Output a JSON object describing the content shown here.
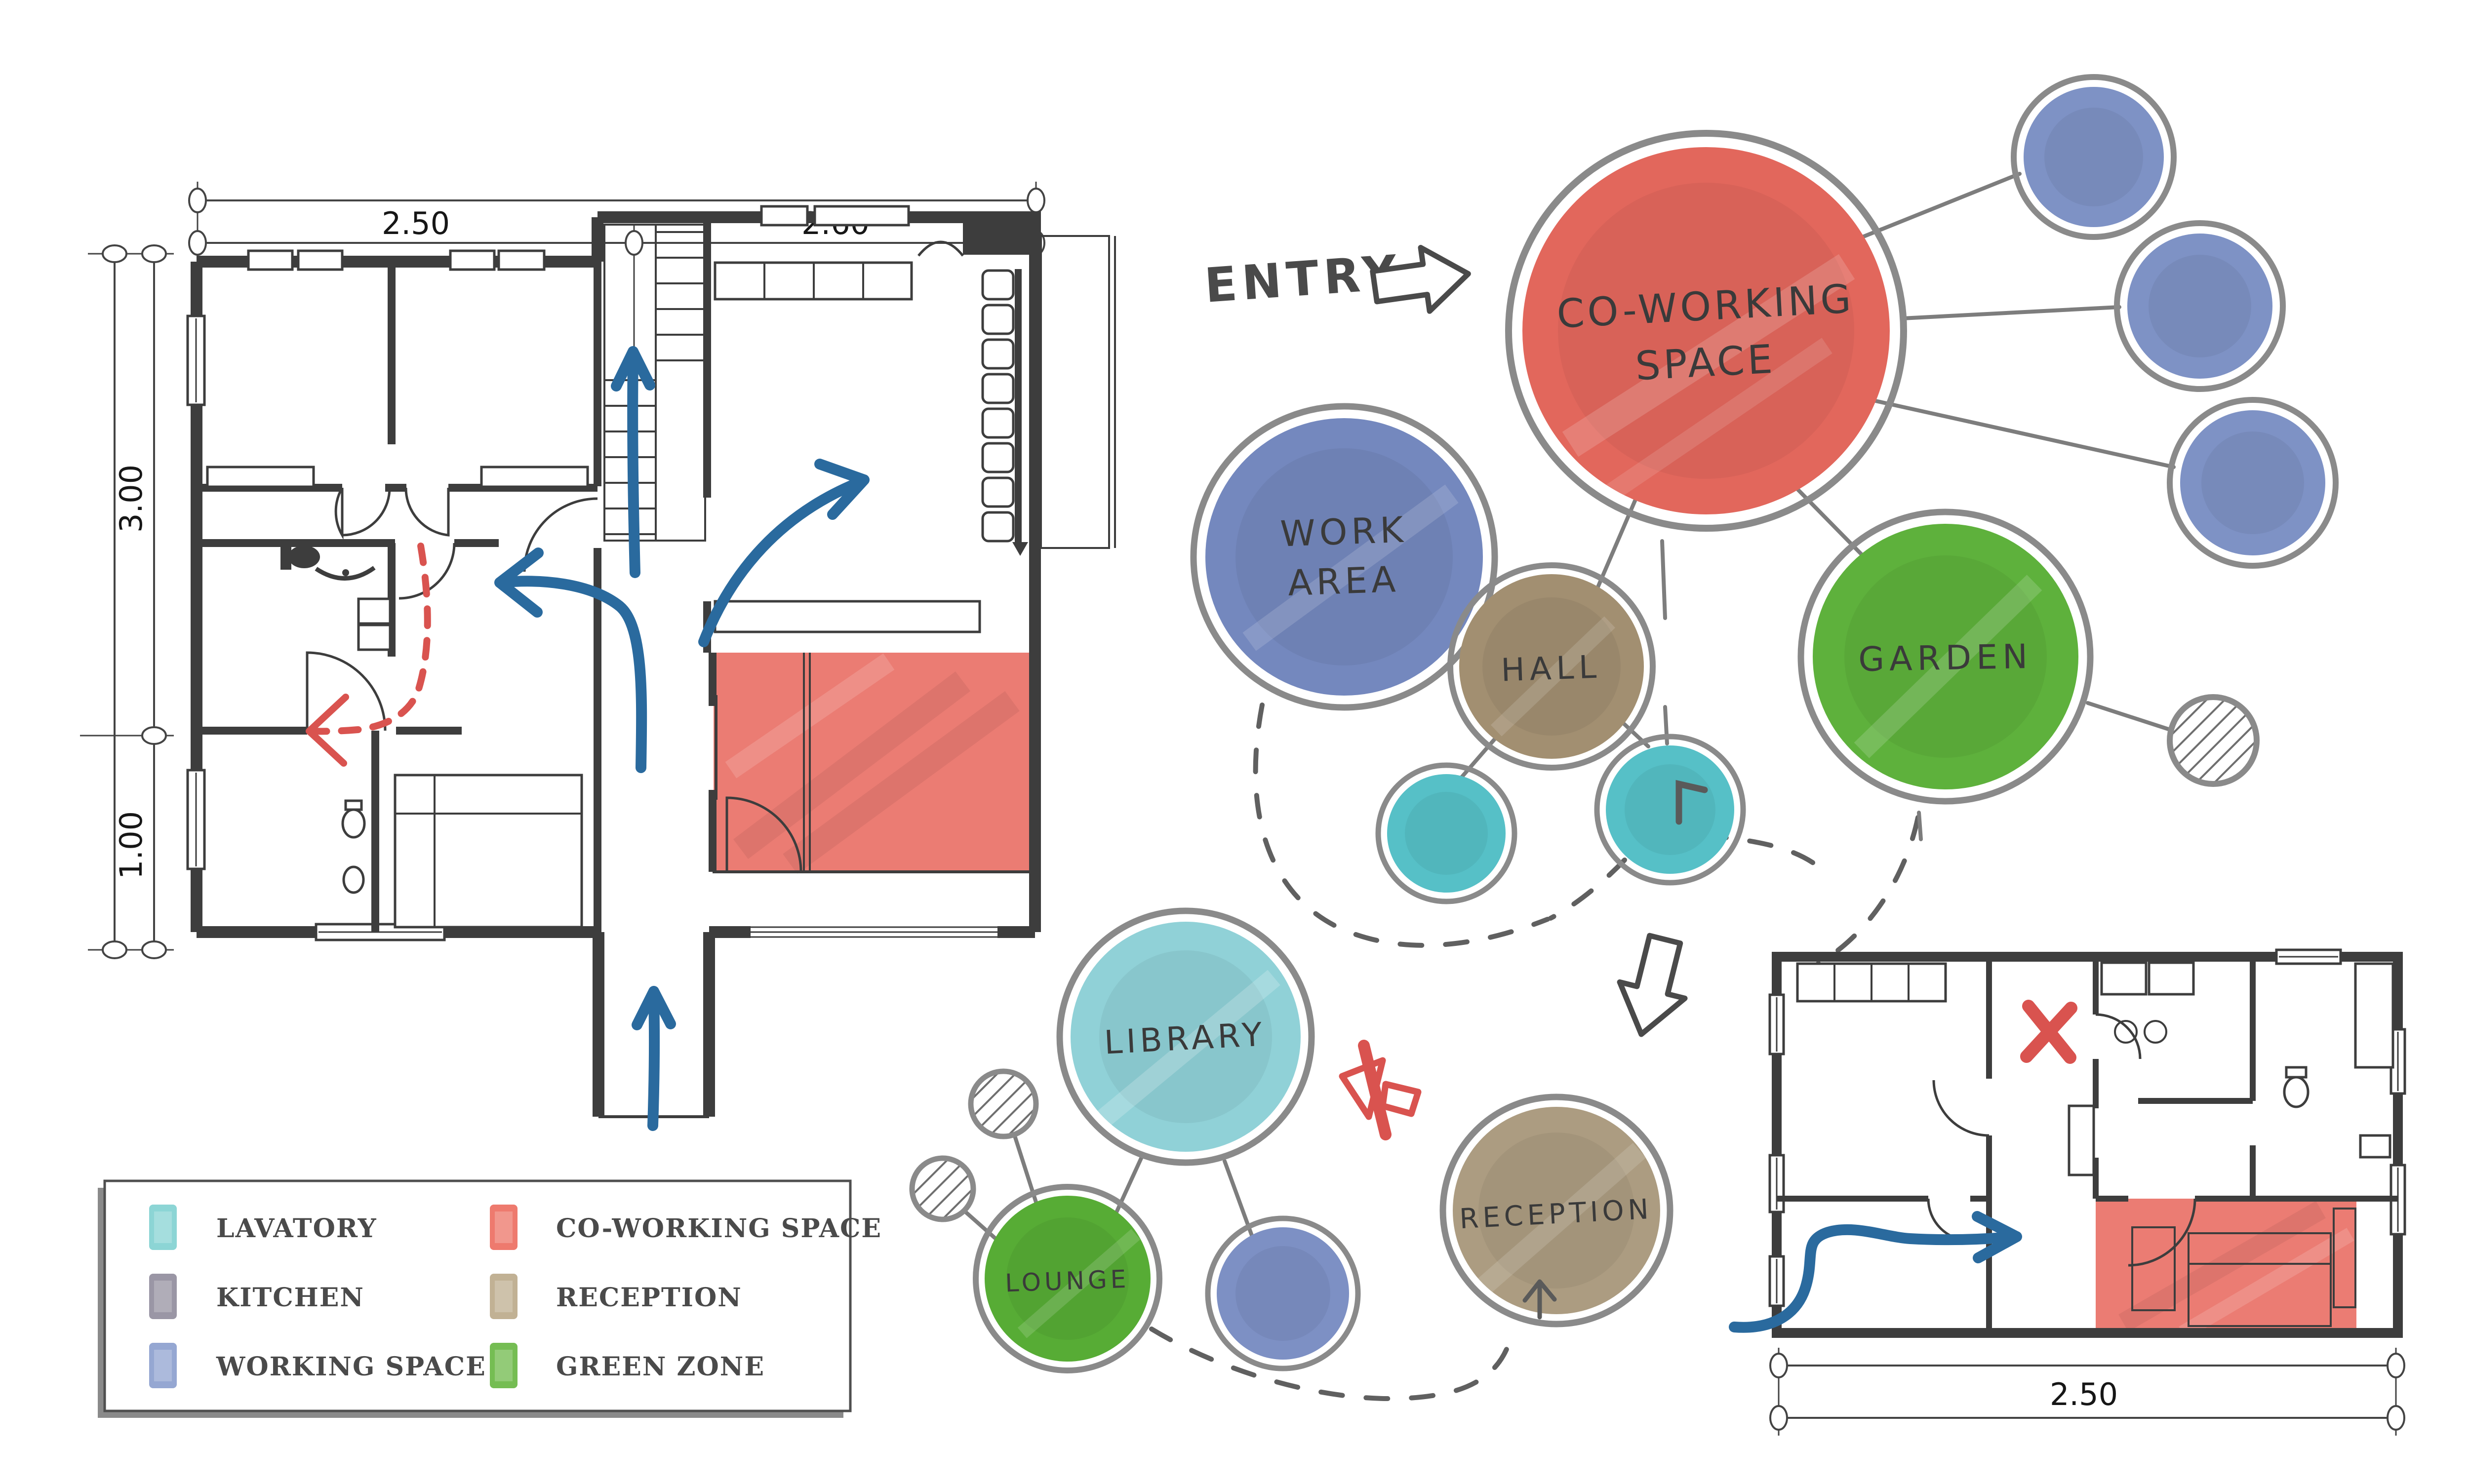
{
  "entry": {
    "label": "ENTRY"
  },
  "bubbles": {
    "coworking": {
      "line1": "CO-WORKING",
      "line2": "SPACE",
      "color": "#e2675c"
    },
    "work_area": {
      "line1": "WORK",
      "line2": "AREA",
      "color": "#7488be"
    },
    "hall": {
      "label": "HALL",
      "color": "#a28f71"
    },
    "garden": {
      "label": "GARDEN",
      "color": "#5eb13c"
    },
    "library": {
      "label": "LIBRARY",
      "color": "#90d1d7"
    },
    "lounge": {
      "label": "LOUNGE",
      "color": "#57ac35"
    },
    "reception": {
      "label": "RECEPTION",
      "color": "#ac9c81"
    },
    "satellite_color": "#7e92c5",
    "lavatory_color": "#56c0c7",
    "small_blue_color": "#7d90c4"
  },
  "dimensions": {
    "plan_top_left": "2.50",
    "plan_top_right": "2.60",
    "plan_left_upper": "3.00",
    "plan_left_lower": "1.00",
    "plan_small_bottom": "2.50"
  },
  "legend": {
    "items": [
      {
        "label": "LAVATORY",
        "color": "#8cd5d5"
      },
      {
        "label": "KITCHEN",
        "color": "#9a96a5"
      },
      {
        "label": "WORKING SPACE",
        "color": "#95a7d2"
      },
      {
        "label": "CO-WORKING SPACE",
        "color": "#ee7a6e"
      },
      {
        "label": "RECEPTION",
        "color": "#c1b194"
      },
      {
        "label": "GREEN ZONE",
        "color": "#75bd53"
      }
    ]
  },
  "palette": {
    "wall": "#3d3d3d",
    "highlight_room": "#e8695e",
    "arrow_blue": "#2a6a9e",
    "annotation_red": "#d9534f",
    "bubble_outline": "#8a8a8a",
    "dashed_path": "#606060",
    "text": "#3a3a3a"
  }
}
